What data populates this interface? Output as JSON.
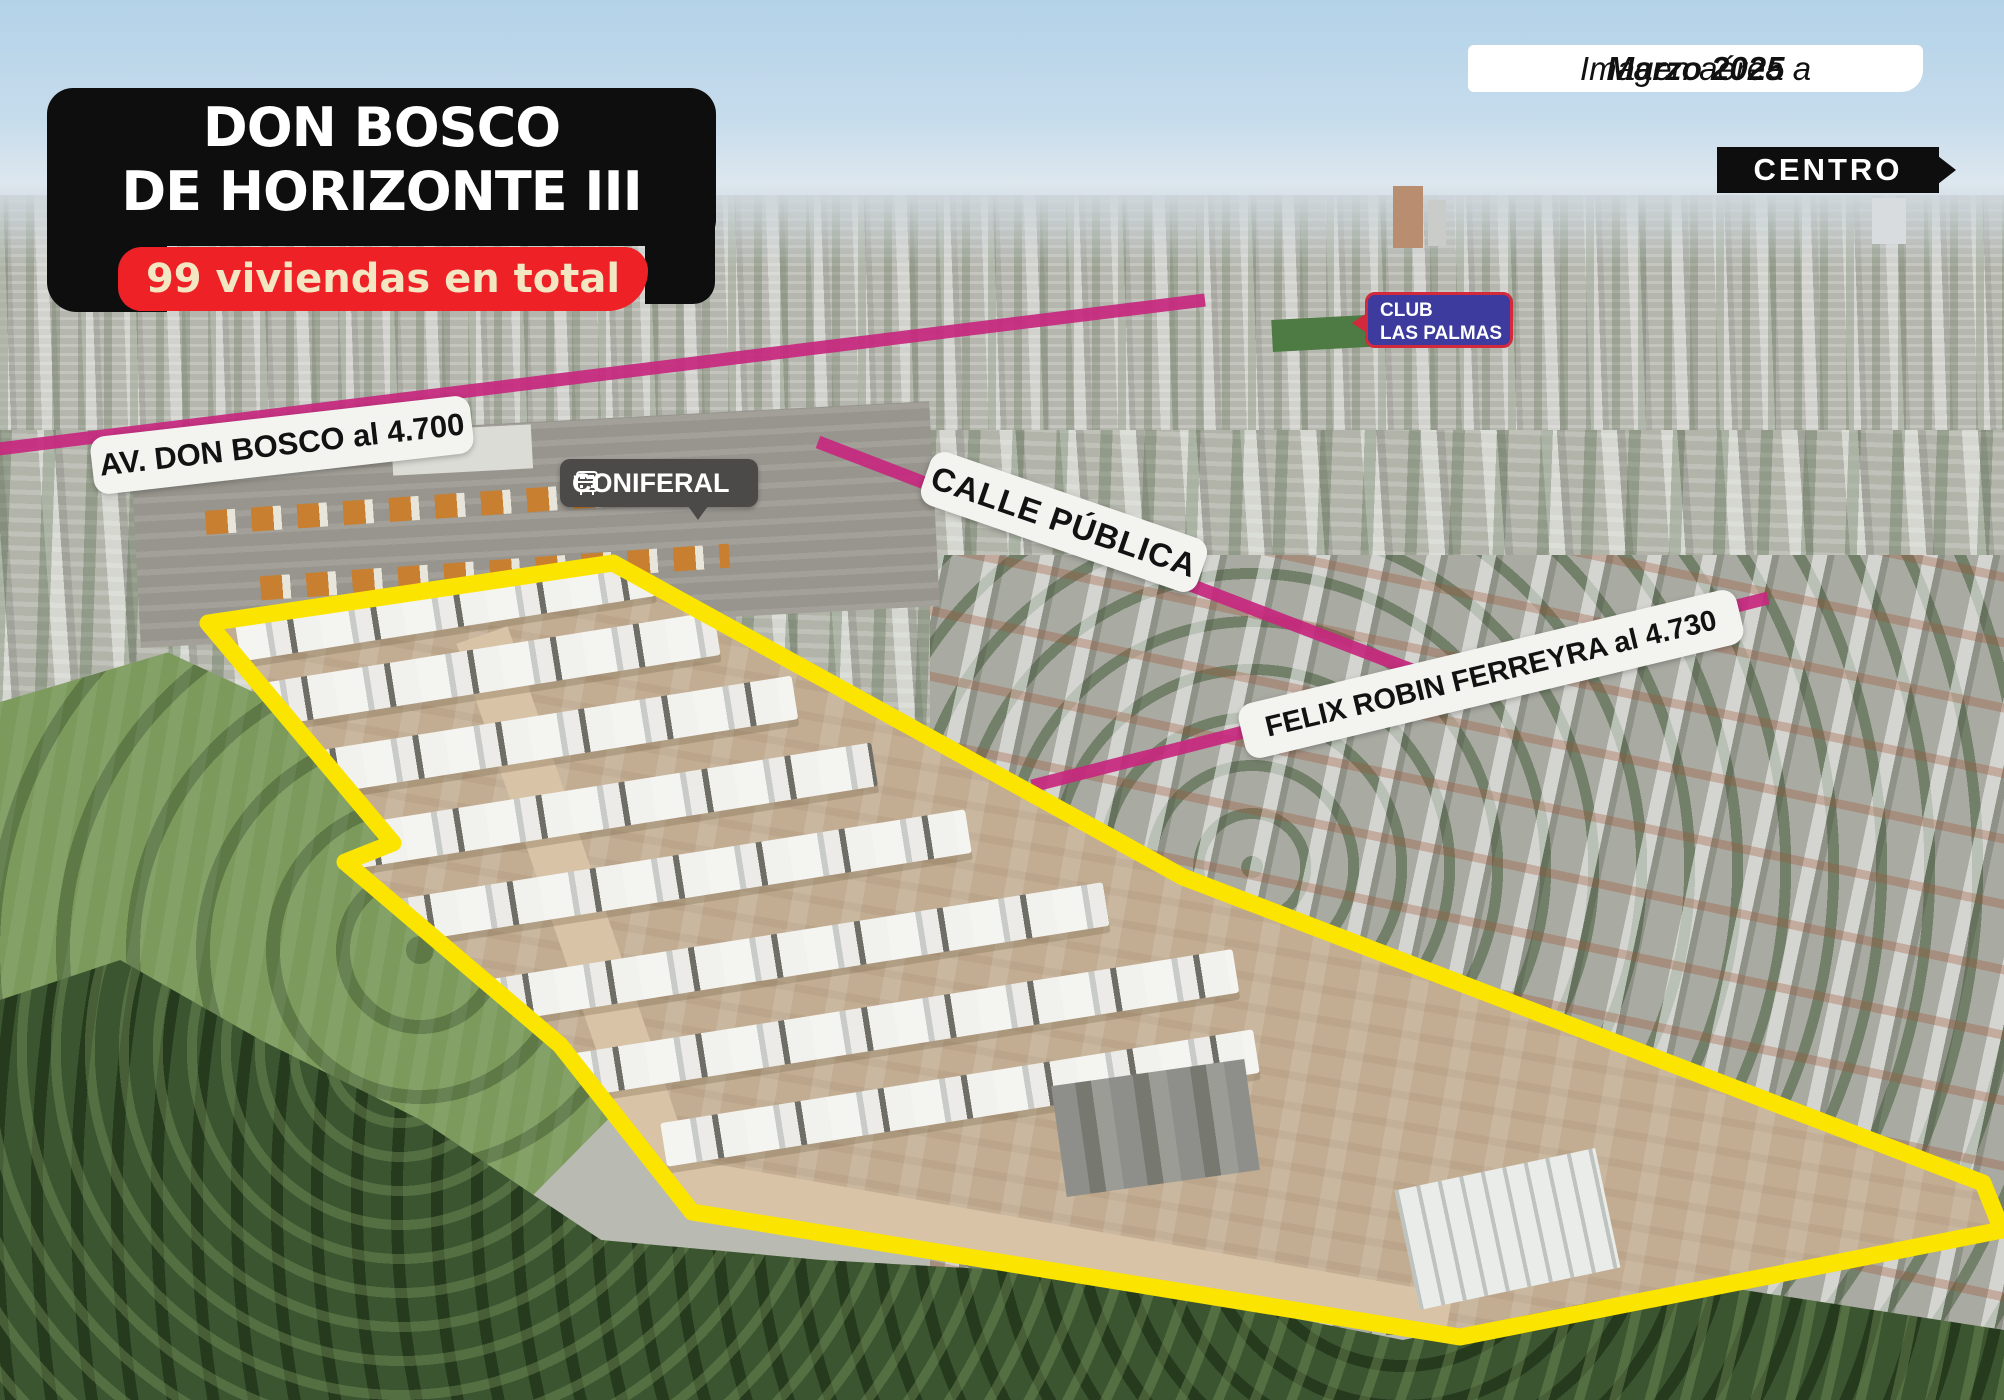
{
  "header": {
    "project_title_line1": "DON BOSCO",
    "project_title_line2": "DE HORIZONTE III",
    "project_subtitle": "99 viviendas en total",
    "caption_prefix": "Imagen aérea a",
    "caption_date": "Marzo 2025"
  },
  "map_labels": {
    "centro": "CENTRO",
    "club_line1": "CLUB",
    "club_line2": "LAS PALMAS",
    "street_av_don_bosco": "AV. DON BOSCO al 4.700",
    "street_calle_publica": "CALLE PÚBLICA",
    "street_felix_robin": "FELIX ROBIN FERREYRA al 4.730",
    "company": "CONIFERAL"
  },
  "icons": {
    "coniferal": "bus-icon",
    "centro_pointer": "arrow-right-icon"
  },
  "colors": {
    "highlight_yellow": "#FBE400",
    "street_pink": "#C7277E",
    "banner_red": "#EE2226",
    "banner_text_cream": "#F3E6C2",
    "badge_black": "#0E0E0E",
    "club_blue": "#3D3B9E",
    "club_border_red": "#D22A3C"
  }
}
